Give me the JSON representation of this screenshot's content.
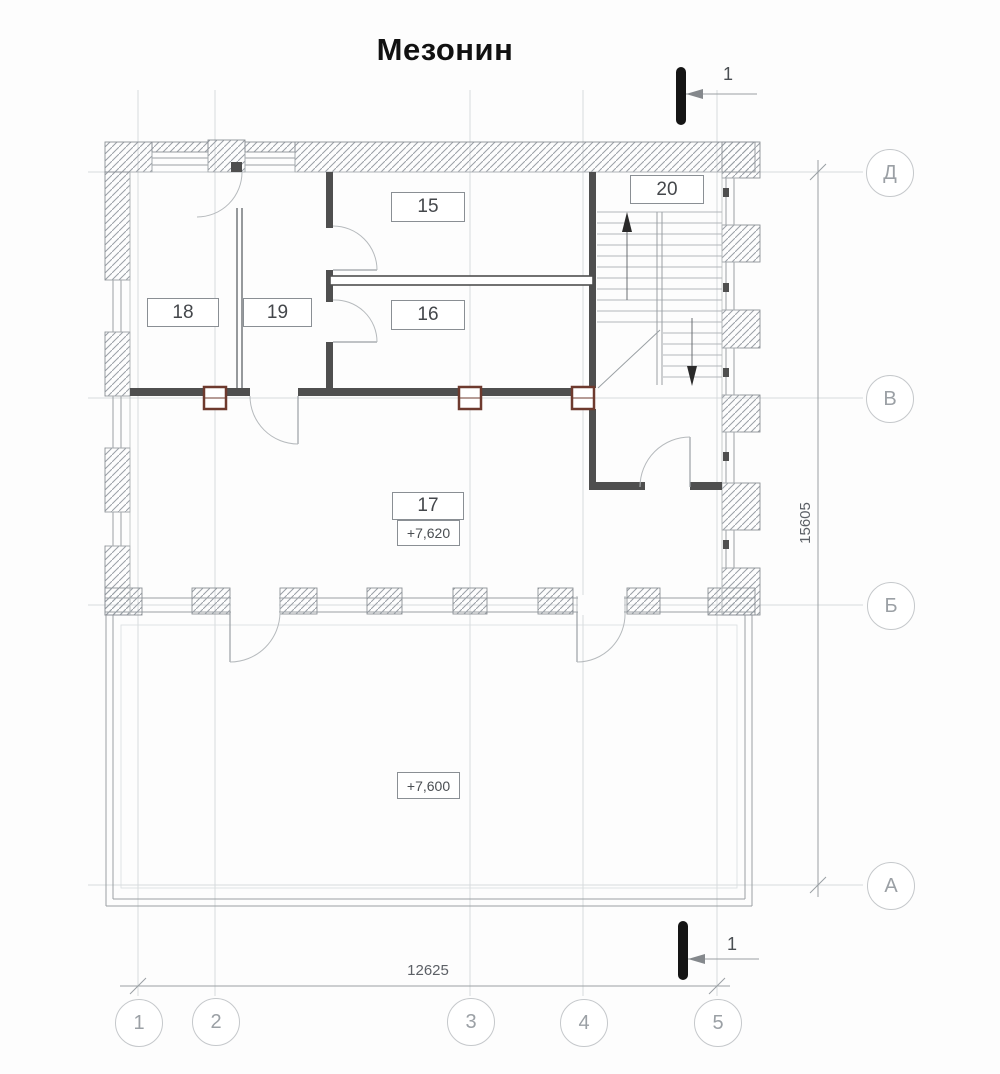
{
  "title": "Мезонин",
  "section_cut": {
    "top_label": "1",
    "bottom_label": "1"
  },
  "rooms": {
    "r15": "15",
    "r16": "16",
    "r17": "17",
    "r18": "18",
    "r19": "19",
    "r20": "20"
  },
  "elevations": {
    "mezzanine_floor": "+7,620",
    "terrace_floor": "+7,600"
  },
  "dimensions": {
    "overall_width": "12625",
    "overall_height": "15605"
  },
  "axes": {
    "rows": [
      "Д",
      "В",
      "Б",
      "А"
    ],
    "cols": [
      "1",
      "2",
      "3",
      "4",
      "5"
    ]
  },
  "colors": {
    "wall": "#4f4f4f",
    "hatch_line": "#9aa0a6",
    "drawing_line": "#8a8f94",
    "grid_line": "#d7dadd",
    "column_accent": "#6e3a2e",
    "text_muted": "#7d8187",
    "title_text": "#111111",
    "section_mark": "#151515"
  }
}
